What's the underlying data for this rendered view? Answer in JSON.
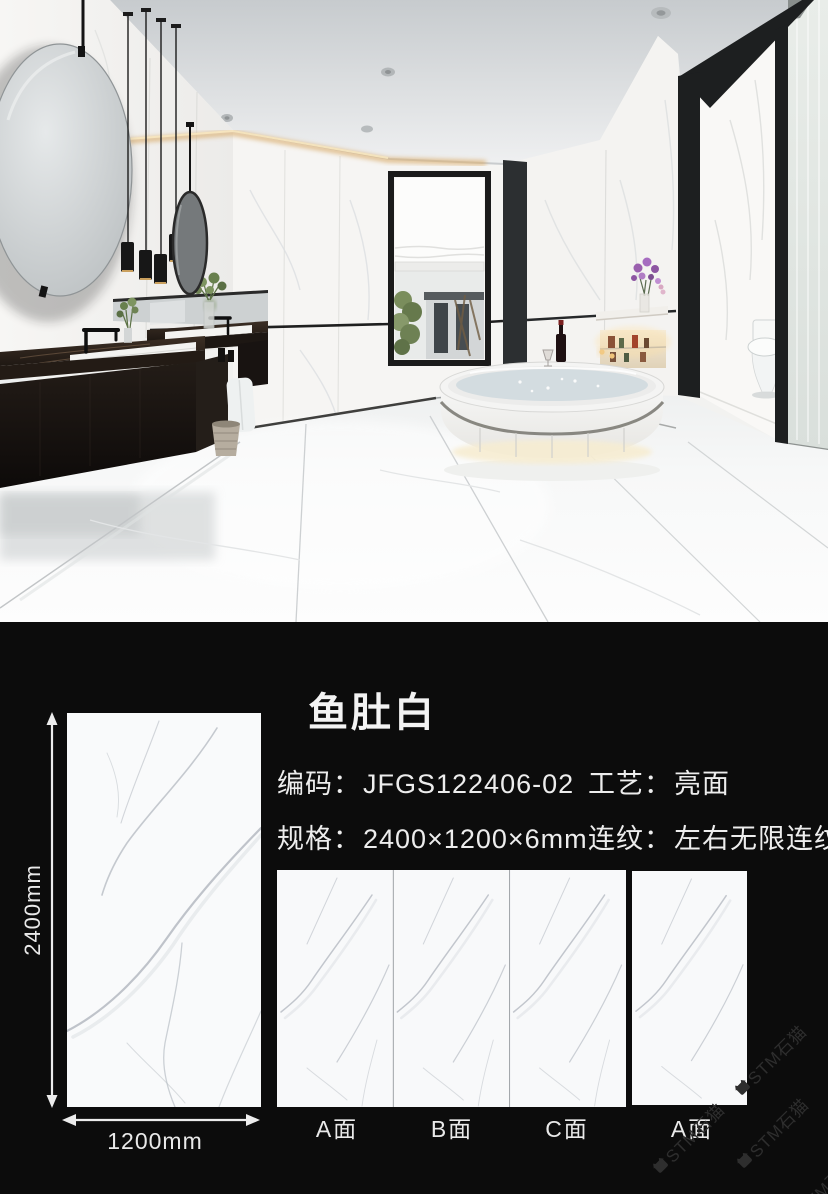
{
  "product": {
    "title": "鱼肚白",
    "fields": {
      "code": {
        "label": "编码：",
        "value": "JFGS122406-02"
      },
      "finish": {
        "label": "工艺：",
        "value": "亮面"
      },
      "size": {
        "label": "规格：",
        "value": "2400×1200×6mm"
      },
      "pattern": {
        "label": "连纹：",
        "value": "左右无限连纹"
      }
    }
  },
  "dimensions": {
    "height": "2400mm",
    "width": "1200mm"
  },
  "faces": {
    "a": "A面",
    "b": "B面",
    "c": "C面",
    "a2": "A面"
  },
  "watermark": {
    "text": "STM石猫"
  },
  "colors": {
    "section_background": "#0c0c0c",
    "text": "#f0f0f0",
    "tile_white": "#f9fafb"
  }
}
